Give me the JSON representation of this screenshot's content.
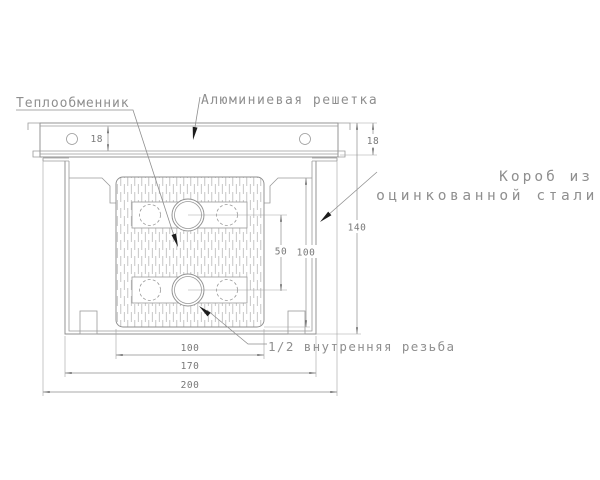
{
  "drawing": {
    "labels": {
      "heat_exchanger": "Теплообменник",
      "aluminum_grille": "Алюминиевая решетка",
      "box_material_line1": "Короб из",
      "box_material_line2": "оцинкованной стали",
      "thread": "1/2 внутренняя резьба"
    },
    "dimensions": {
      "grille_height_left": "18",
      "grille_height_right": "18",
      "overall_height": "140",
      "exchanger_height": "100",
      "pipe_center_spacing": "50",
      "exchanger_width": "100",
      "box_width": "170",
      "grille_width": "200"
    },
    "colors": {
      "background": "#ffffff",
      "line": "#9a9a9a",
      "hatch": "#b8b8b8",
      "text": "#8f8f8f",
      "leader_arrow": "#1c1c1c",
      "dim_arrow": "#5a5a5a"
    }
  }
}
